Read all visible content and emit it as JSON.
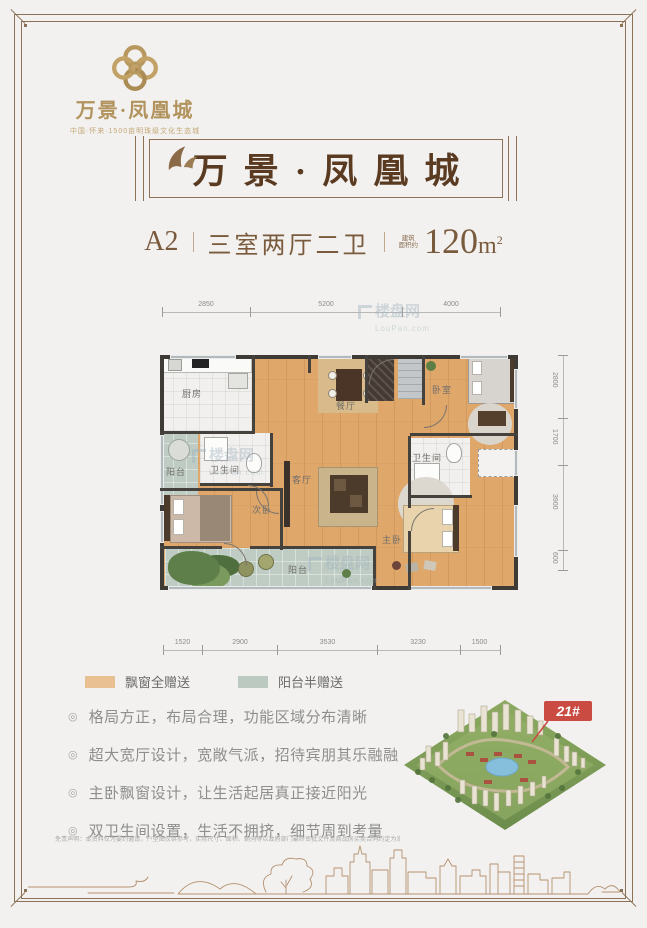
{
  "page": {
    "bg": "#f2f1ef",
    "frame_color": "#8d7156"
  },
  "logo": {
    "brand": "万景·凤凰城",
    "tagline": "中国·怀来·1500亩明珠级文化生态城"
  },
  "banner": {
    "title": "万景·凤凰城"
  },
  "unit": {
    "code": "A2",
    "layout": "三室两厅二卫",
    "area_note_top": "建筑",
    "area_note_bottom": "面积约",
    "area_value": "120",
    "area_unit": "m",
    "area_sup": "2"
  },
  "floorplan": {
    "dims_top": [
      "2850",
      "5200",
      "4000"
    ],
    "dims_bottom": [
      "1520",
      "2900",
      "3530",
      "3230",
      "1500"
    ],
    "dims_right": [
      "2800",
      "1700",
      "3900",
      "600"
    ],
    "rooms": {
      "kitchen": "厨房",
      "balcony_left": "阳台",
      "bath_1": "卫生间",
      "dining": "餐厅",
      "bedroom": "卧室",
      "bath_2": "卫生间",
      "second_bedroom": "次卧",
      "living": "客厅",
      "master_bedroom": "主卧",
      "balcony_bottom": "阳台"
    },
    "watermark": {
      "name": "楼盘网",
      "domain": "LouPan.com"
    }
  },
  "legend": {
    "items": [
      {
        "label": "飘窗全赠送",
        "color": "#e8c091"
      },
      {
        "label": "阳台半赠送",
        "color": "#bcc9c0"
      }
    ]
  },
  "features": {
    "marker": "◎",
    "items": [
      "格局方正，布局合理，功能区域分布清晰",
      "超大宽厅设计，宽敞气派，招待宾朋其乐融融",
      "主卧飘窗设计，让生活起居真正接近阳光",
      "双卫生间设置，生活不拥挤，细节周到考量"
    ]
  },
  "rendering": {
    "building_tag": "21#"
  },
  "disclaimer": "免责声明：本资料仅为要约邀请，户型图仅供参考，实际尺寸、面积、朝向等以政府部门最终审批文件及商品房买卖合同约定为准，开发商保留对宣传资料修改的权利，敬请留意最新资料。"
}
